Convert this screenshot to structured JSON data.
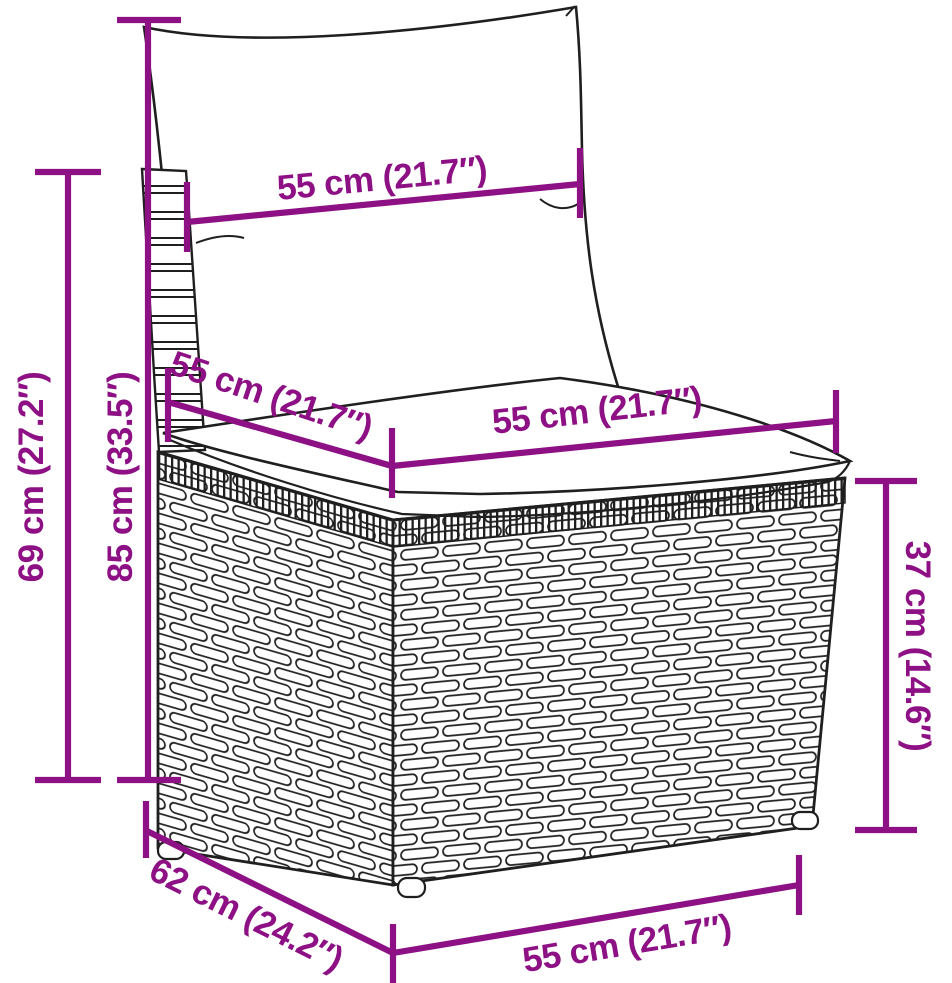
{
  "diagram": {
    "accent_color": "#8D1084",
    "art_color": "#1f1f1f",
    "dimensions": {
      "backrest_width": "55 cm (21.7″)",
      "seat_depth": "55 cm (21.7″)",
      "seat_width": "55 cm (21.7″)",
      "overall_height": "85 cm (33.5″)",
      "back_height": "69 cm (27.2″)",
      "overall_depth": "62 cm (24.2″)",
      "base_height": "37 cm (14.6″)",
      "bottom_width": "55 cm (21.7″)"
    }
  }
}
